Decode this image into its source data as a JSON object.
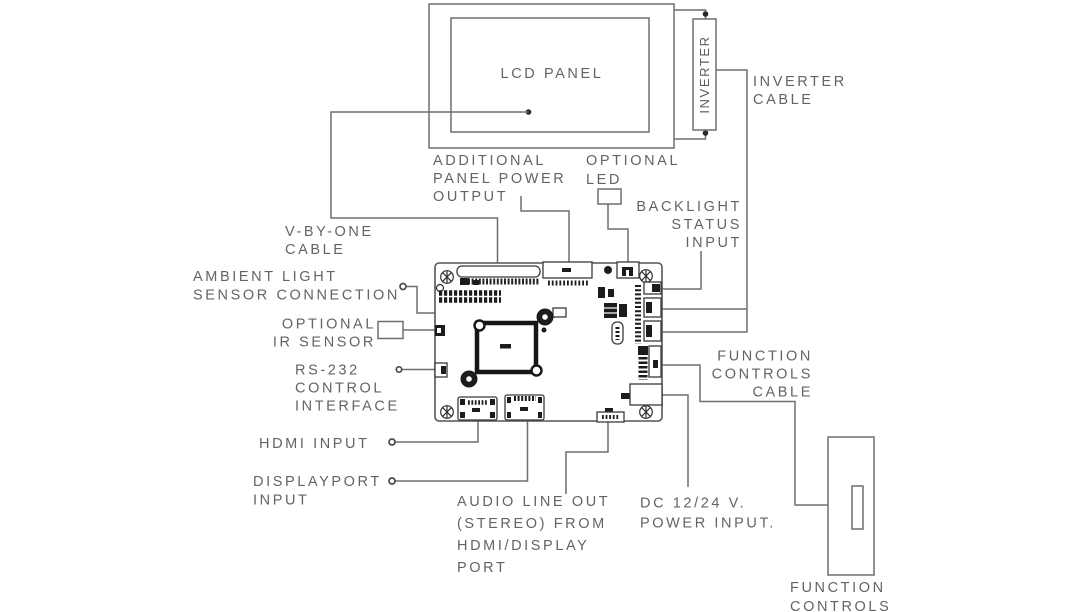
{
  "diagram": {
    "type": "lcd-controller-board-connection-diagram",
    "colors": {
      "background": "#ffffff",
      "line": "#6f6f6f",
      "text": "#646464",
      "part_dark": "#1c1c1c"
    },
    "labels": {
      "lcd_panel": "LCD PANEL",
      "inverter": "INVERTER",
      "inverter_cable": [
        "INVERTER",
        "CABLE"
      ],
      "additional_panel_power_output": [
        "ADDITIONAL",
        "PANEL POWER",
        "OUTPUT"
      ],
      "optional_led": [
        "OPTIONAL",
        "LED"
      ],
      "backlight_status_input": [
        "BACKLIGHT",
        "STATUS",
        "INPUT"
      ],
      "v_by_one_cable": [
        "V-BY-ONE",
        "CABLE"
      ],
      "ambient_light_sensor_connection": [
        "AMBIENT LIGHT",
        "SENSOR CONNECTION"
      ],
      "optional_ir_sensor": [
        "OPTIONAL",
        "IR SENSOR"
      ],
      "rs_232_control_interface": [
        "RS-232",
        "CONTROL",
        "INTERFACE"
      ],
      "hdmi_input": "HDMI INPUT",
      "displayport_input": [
        "DISPLAYPORT",
        "INPUT"
      ],
      "audio_line_out": [
        "AUDIO LINE OUT",
        "(STEREO) FROM",
        "HDMI/DISPLAY",
        "PORT"
      ],
      "dc_power_input": [
        "DC 12/24 V.",
        "POWER INPUT."
      ],
      "function_controls_cable": [
        "FUNCTION",
        "CONTROLS",
        "CABLE"
      ],
      "function_controls": [
        "FUNCTION",
        "CONTROLS"
      ]
    }
  }
}
